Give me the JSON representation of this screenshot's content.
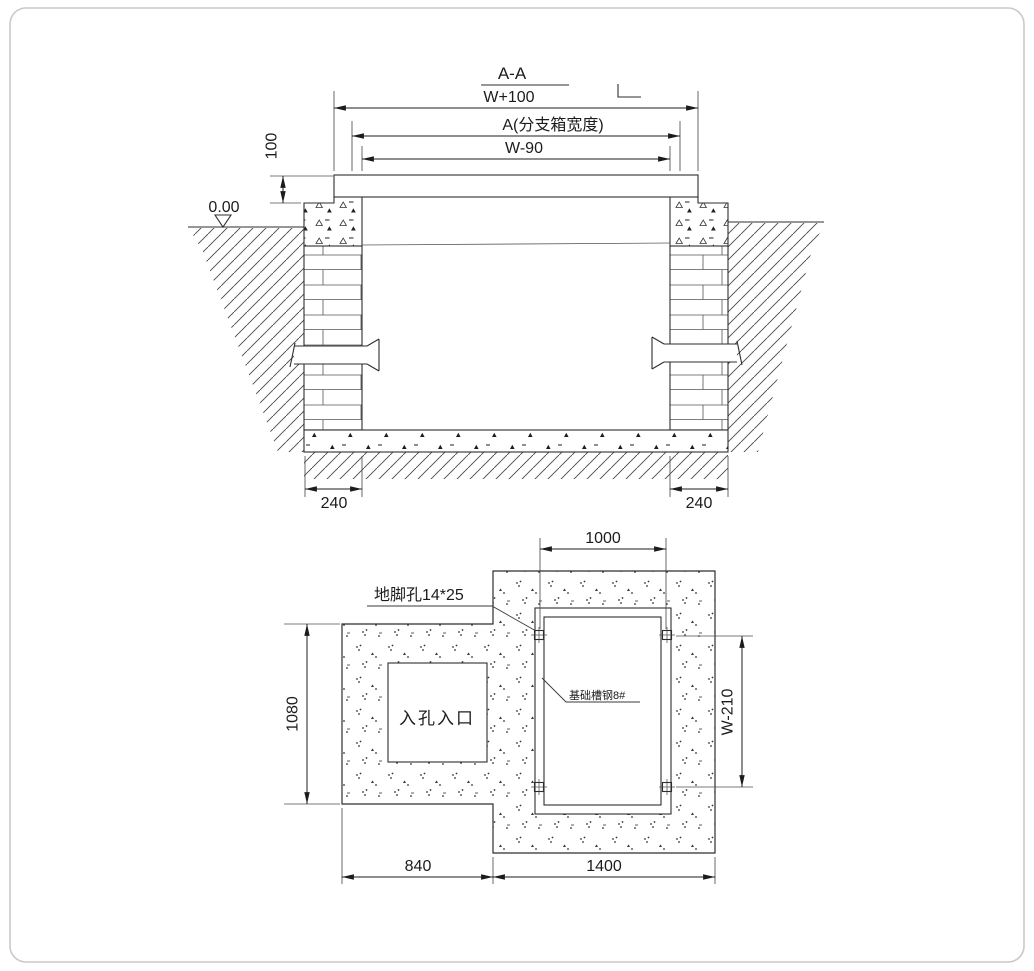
{
  "section_view": {
    "title": "A-A",
    "dim_overall_width": "W+100",
    "dim_box_width": "A(分支箱宽度)",
    "dim_clear_width": "W-90",
    "dim_plate_height": "100",
    "level_mark": "0.00",
    "dim_wall_left": "240",
    "dim_wall_right": "240"
  },
  "plan_view": {
    "dim_top": "1000",
    "dim_left": "1080",
    "dim_right": "W-210",
    "dim_bottom_left": "840",
    "dim_bottom_right": "1400",
    "anchor_hole_label": "地脚孔14*25",
    "channel_steel_label": "基础槽钢8#",
    "manhole_label": "入孔入口"
  },
  "colors": {
    "line": "#2e2e2e",
    "text": "#1c1c1c",
    "border": "#c9c9c9",
    "background": "#ffffff"
  }
}
